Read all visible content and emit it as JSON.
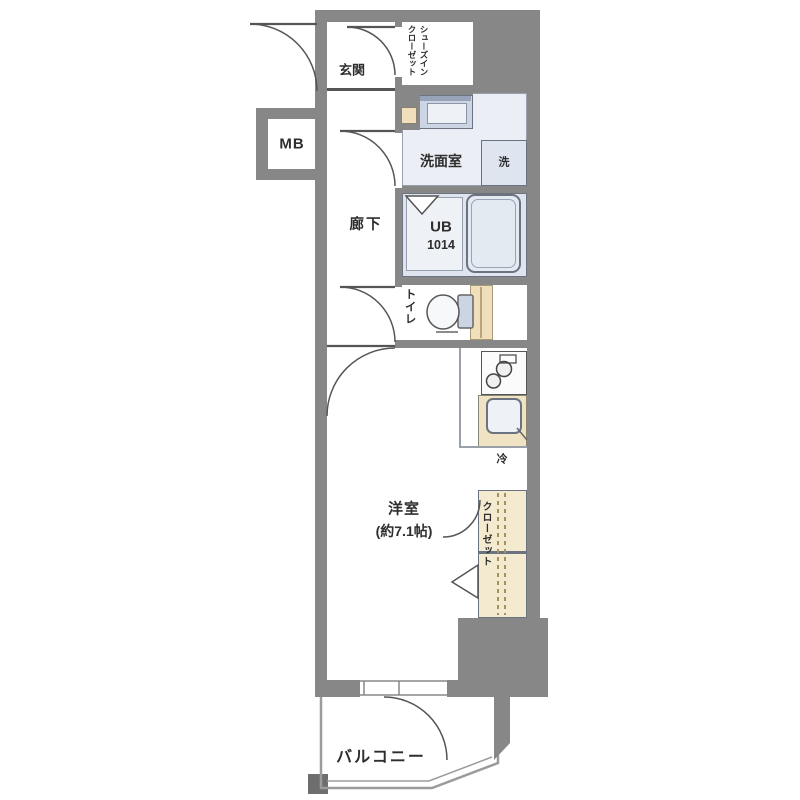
{
  "floorplan": {
    "labels": {
      "genkan": "玄関",
      "shoe_closet_l1": "シューズイン",
      "shoe_closet_l2": "クローゼット",
      "meter_box": "MB",
      "washroom": "洗面室",
      "washer": "洗",
      "corridor": "廊下",
      "unit_bath": "UB",
      "unit_bath_size": "1014",
      "toilet": "トイレ",
      "room": "洋室",
      "room_size": "(約7.1帖)",
      "fridge": "冷",
      "closet": "クローゼット",
      "balcony": "バルコニー"
    },
    "colors": {
      "wall": "#878787",
      "wall_dark": "#6e6e6e",
      "cream": "#f0dfba",
      "cream_light": "#f8efda",
      "cream_closet": "#f4ead0",
      "blue": "#ccd5e4",
      "blue_light": "#dfe5ef",
      "blue_pale": "#eef1f6",
      "floor_tint": "#ebeef4",
      "counter": "#f0e3c3",
      "line": "#555555",
      "bal_line": "#9b9b9b",
      "text": "#2e2e2e"
    }
  }
}
